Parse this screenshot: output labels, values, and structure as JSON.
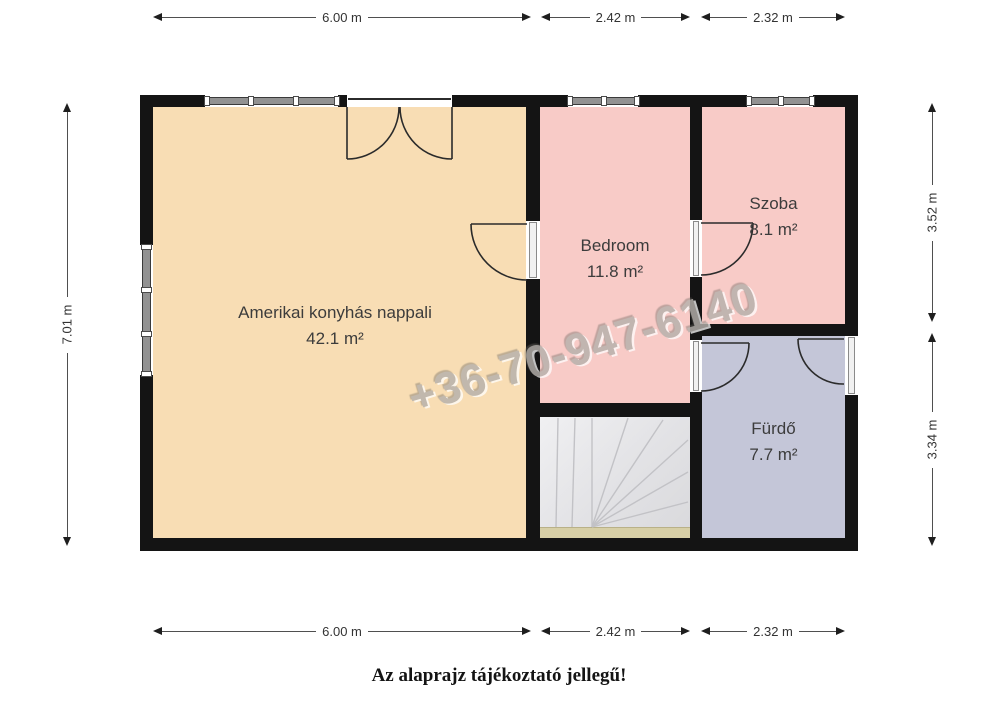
{
  "floor_plan": {
    "watermark": "+36-70-947-6140",
    "caption": "Az alaprajz tájékoztató jellegű!",
    "rooms": [
      {
        "id": "living-room",
        "label": "Amerikai konyhás nappali",
        "area": "42.1 m²"
      },
      {
        "id": "bedroom",
        "label": "Bedroom",
        "area": "11.8 m²"
      },
      {
        "id": "szoba",
        "label": "Szoba",
        "area": "8.1 m²"
      },
      {
        "id": "furdo",
        "label": "Fürdő",
        "area": "7.7 m²"
      }
    ],
    "dimensions": {
      "top": [
        "6.00 m",
        "2.42 m",
        "2.32 m"
      ],
      "bottom": [
        "6.00 m",
        "2.42 m",
        "2.32 m"
      ],
      "left": [
        "7.01 m"
      ],
      "right": [
        "3.52 m",
        "3.34 m"
      ]
    },
    "colors": {
      "wall": "#141414",
      "living_room": "#f8ddb4",
      "bedroom": "#f8cbc7",
      "szoba": "#f8cbc7",
      "furdo": "#c4c6d8",
      "stairs": "#e6e6e9",
      "stair_landing": "#d7cfa6",
      "dimension_text": "#333333",
      "watermark": "#b5b1ac"
    }
  }
}
